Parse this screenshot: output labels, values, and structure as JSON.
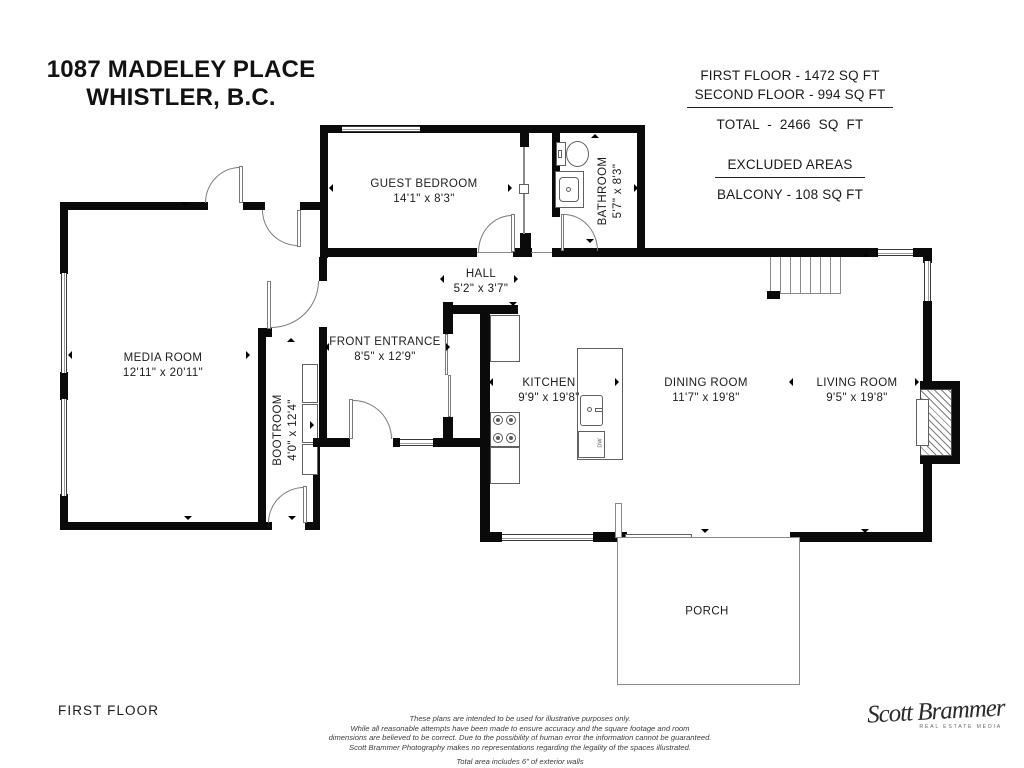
{
  "header": {
    "title_line1": "1087 MADELEY PLACE",
    "title_line2": "WHISTLER, B.C."
  },
  "area_summary": {
    "first_floor": "FIRST FLOOR - 1472 SQ FT",
    "second_floor": "SECOND FLOOR - 994 SQ FT",
    "total": "TOTAL - 2466 SQ FT",
    "excluded_heading": "EXCLUDED AREAS",
    "balcony": "BALCONY - 108 SQ FT"
  },
  "rooms": {
    "guest_bedroom": {
      "name": "GUEST BEDROOM",
      "dims": "14'1\" x 8'3\""
    },
    "bathroom": {
      "name": "BATHROOM",
      "dims": "5'7\" x 8'3\""
    },
    "hall": {
      "name": "HALL",
      "dims": "5'2\" x 3'7\""
    },
    "front_entrance": {
      "name": "FRONT ENTRANCE",
      "dims": "8'5\" x 12'9\""
    },
    "media_room": {
      "name": "MEDIA ROOM",
      "dims": "12'11\" x 20'11\""
    },
    "bootroom": {
      "name": "BOOTROOM",
      "dims": "4'0\" x 12'4\""
    },
    "kitchen": {
      "name": "KITCHEN",
      "dims": "9'9\" x 19'8\""
    },
    "dining_room": {
      "name": "DINING ROOM",
      "dims": "11'7\" x 19'8\""
    },
    "living_room": {
      "name": "LIVING ROOM",
      "dims": "9'5\" x 19'8\""
    },
    "porch": {
      "name": "PORCH"
    }
  },
  "fixtures": {
    "dishwasher_label": "DW"
  },
  "floor_label": "FIRST FLOOR",
  "disclaimer": {
    "line1": "These plans are intended to be used for illustrative purposes only.",
    "line2": "While all reasonable attempts have been made to ensure accuracy and the square footage and room",
    "line3": "dimensions are believed to be correct.  Due to the possibility of human error the information cannot be guaranteed.",
    "line4": "Scott Brammer Photography makes no representations regarding the legality of the spaces illustrated.",
    "note": "Total area includes 6\" of exterior walls"
  },
  "logo": {
    "script": "Scott Brammer",
    "subtitle": "REAL ESTATE MEDIA"
  }
}
